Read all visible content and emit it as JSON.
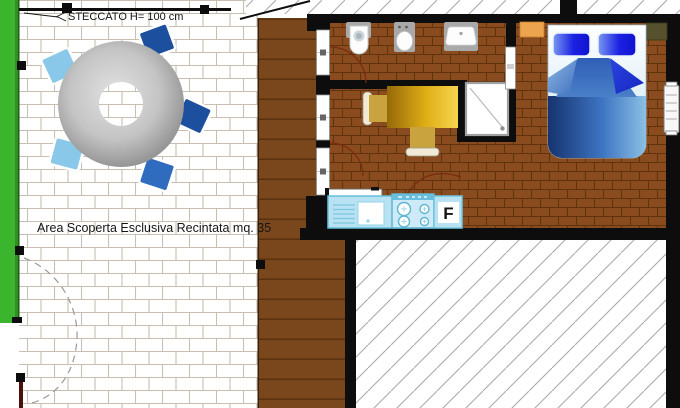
{
  "plan": {
    "fence_label": "STECCATO H= 100 cm",
    "area_label": "Area Scoperta Esclusiva Recintata mq. 35",
    "kitchen": {
      "fridge_label": "F"
    }
  },
  "colors": {
    "fence_green": "#3bb42e",
    "fence_green_dark": "#2e9122",
    "terrace_mortar": "#c8bfb2",
    "deck_brown": "#7a471c",
    "interior_brick": "#8a4c1e",
    "interior_mortar": "#5e330e",
    "wall_black": "#0d0d0d",
    "kitchen_cyan": "#b8e2f2",
    "kitchen_border": "#66c0da",
    "fridge_letter": "#29a5c9",
    "bed_dark_blue": "#1d3c82",
    "bed_light_blue": "#8ac0e4",
    "pillow_blue": "#1111d8",
    "table_gold": "#e8b820",
    "outdoor_table_gray": "#9a9a9a",
    "chair_light_blue": "#89c8e8",
    "chair_dark_blue": "#1c4f9e"
  }
}
